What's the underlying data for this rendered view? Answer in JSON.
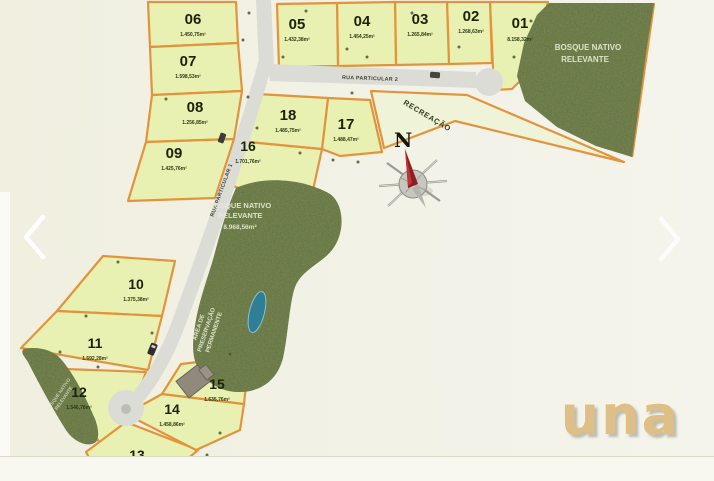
{
  "image": {
    "type": "land-subdivision-site-plan"
  },
  "plan": {
    "lots": [
      {
        "num": "01",
        "area": "8.158,32m²"
      },
      {
        "num": "02",
        "area": "1.268,63m²"
      },
      {
        "num": "03",
        "area": "1.265,84m²"
      },
      {
        "num": "04",
        "area": "1.454,25m²"
      },
      {
        "num": "05",
        "area": "1.432,38m²"
      },
      {
        "num": "06",
        "area": "1.450,75m²"
      },
      {
        "num": "07",
        "area": "1.598,53m²"
      },
      {
        "num": "08",
        "area": "1.256,85m²"
      },
      {
        "num": "09",
        "area": "1.425,76m²"
      },
      {
        "num": "10",
        "area": "1.375,38m²"
      },
      {
        "num": "11",
        "area": "1.592,28m²"
      },
      {
        "num": "12",
        "area": "1.546,76m²"
      },
      {
        "num": "13",
        "area": "1.802,84m²"
      },
      {
        "num": "14",
        "area": "1.458,86m²"
      },
      {
        "num": "15",
        "area": "1.635,76m²"
      },
      {
        "num": "16",
        "area": "1.701,76m²"
      },
      {
        "num": "17",
        "area": "1.488,47m²"
      },
      {
        "num": "18",
        "area": "1.485,75m²"
      }
    ],
    "roads": {
      "rua_particular_1": "RUA PARTICULAR 1",
      "rua_particular_2": "RUA PARTICULAR 2",
      "recreacao": "RECREAÇÃO"
    },
    "forests": {
      "top_right_line1": "BOSQUE NATIVO",
      "top_right_line2": "RELEVANTE",
      "central_line1": "BOSQUE NATIVO",
      "central_line2": "RELEVANTE",
      "central_area": "8.968,56m²",
      "app_line1": "ÁREA DE",
      "app_line2": "PRESERVAÇÃO",
      "app_line3": "PERMANENTE",
      "left_line1": "BOSQUE NATIVO",
      "left_line2": "RELEVANTE"
    },
    "compass": {
      "north_label": "N"
    },
    "colors": {
      "lot_fill": "#e8f0b2",
      "boundary": "#e2943c",
      "forest": "#5f6e3c",
      "road": "#dcdcd6",
      "water": "#2e7f96",
      "background": "#f1f0e2",
      "logo": "#ddbf87"
    }
  },
  "carousel": {
    "prev_label": "previous image",
    "next_label": "next image"
  },
  "logo": {
    "text": "una"
  }
}
